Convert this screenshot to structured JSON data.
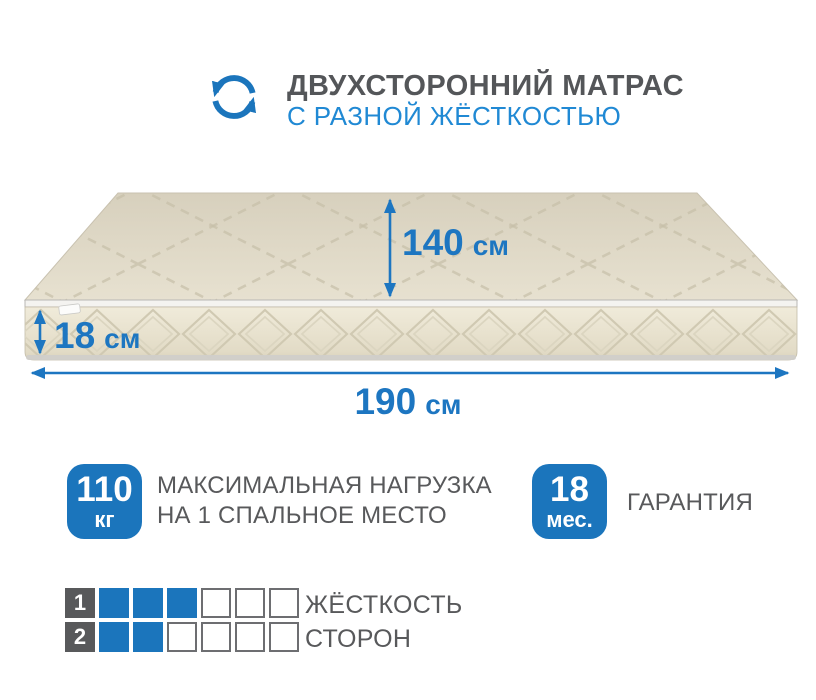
{
  "header": {
    "icon": "two-sided-rotation-icon",
    "title": "ДВУХСТОРОННИЙ МАТРАС",
    "subtitle": "С РАЗНОЙ ЖЁСТКОСТЬЮ"
  },
  "dimensions": {
    "length": {
      "value": "190",
      "unit": "см"
    },
    "width": {
      "value": "140",
      "unit": "см"
    },
    "height": {
      "value": "18",
      "unit": "см"
    }
  },
  "load_badge": {
    "value": "110",
    "unit": "кг",
    "description_line1": "МАКСИМАЛЬНАЯ НАГРУЗКА",
    "description_line2": "НА 1 СПАЛЬНОЕ МЕСТО"
  },
  "warranty_badge": {
    "value": "18",
    "unit": "мес.",
    "label": "ГАРАНТИЯ"
  },
  "firmness": {
    "label_line1": "ЖЁСТКОСТЬ",
    "label_line2": "СТОРОН",
    "rows": [
      {
        "side": "1",
        "filled": 3,
        "total": 6
      },
      {
        "side": "2",
        "filled": 2,
        "total": 6
      }
    ]
  },
  "colors": {
    "accent_blue": "#1b75bc",
    "bright_blue": "#2089d4",
    "text_gray": "#58595b",
    "mattress_top": "#ded8c6",
    "mattress_side": "#ebe5d3"
  }
}
